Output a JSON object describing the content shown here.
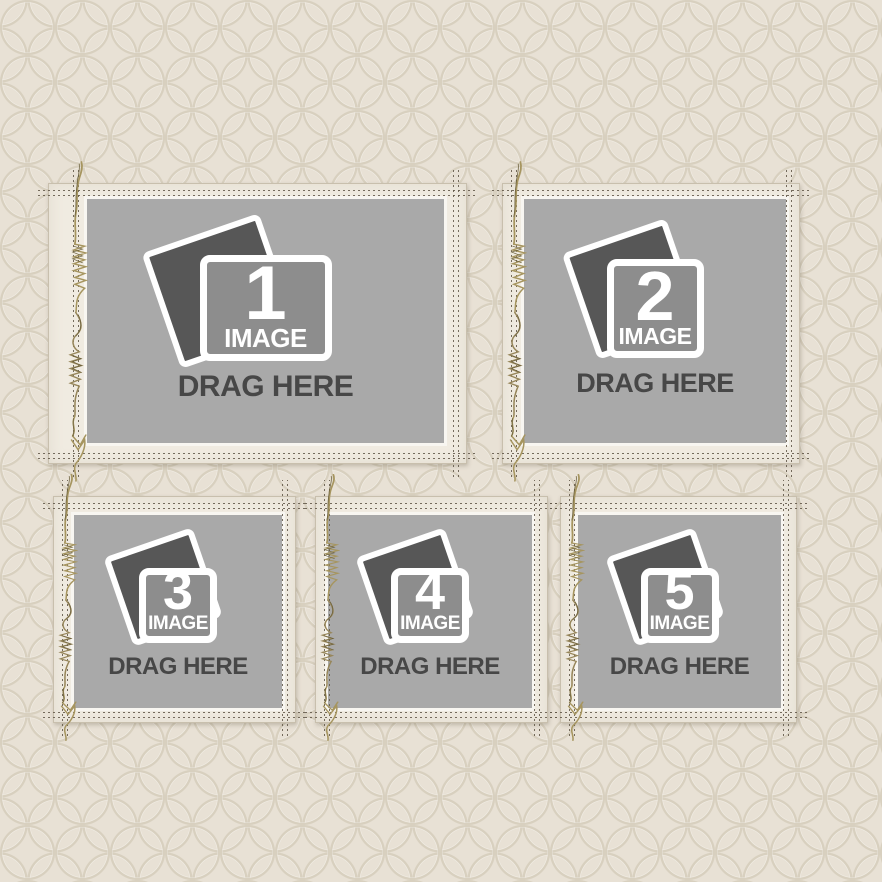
{
  "canvas": {
    "background_color": "#e8e1d5",
    "pattern": "interlocking-circles",
    "pattern_line_color": "#d8d0bf"
  },
  "frames": [
    {
      "number": "1",
      "image_label": "IMAGE",
      "drag_label": "DRAG HERE"
    },
    {
      "number": "2",
      "image_label": "IMAGE",
      "drag_label": "DRAG HERE"
    },
    {
      "number": "3",
      "image_label": "IMAGE",
      "drag_label": "DRAG HERE"
    },
    {
      "number": "4",
      "image_label": "IMAGE",
      "drag_label": "DRAG HERE"
    },
    {
      "number": "5",
      "image_label": "IMAGE",
      "drag_label": "DRAG HERE"
    }
  ],
  "icons": {
    "placeholder": "photo-stack",
    "decoration": [
      "stitch-lines",
      "thread-tangle"
    ]
  },
  "colors": {
    "frame_paper": "#f0ebe1",
    "placeholder_gray": "#a9a9a9",
    "icon_front_gray": "#8d8d8d",
    "icon_back_gray": "#575757",
    "icon_border": "#ffffff",
    "drag_text": "#474747",
    "stitch": "#5f5546",
    "thread": "#a6955f"
  }
}
